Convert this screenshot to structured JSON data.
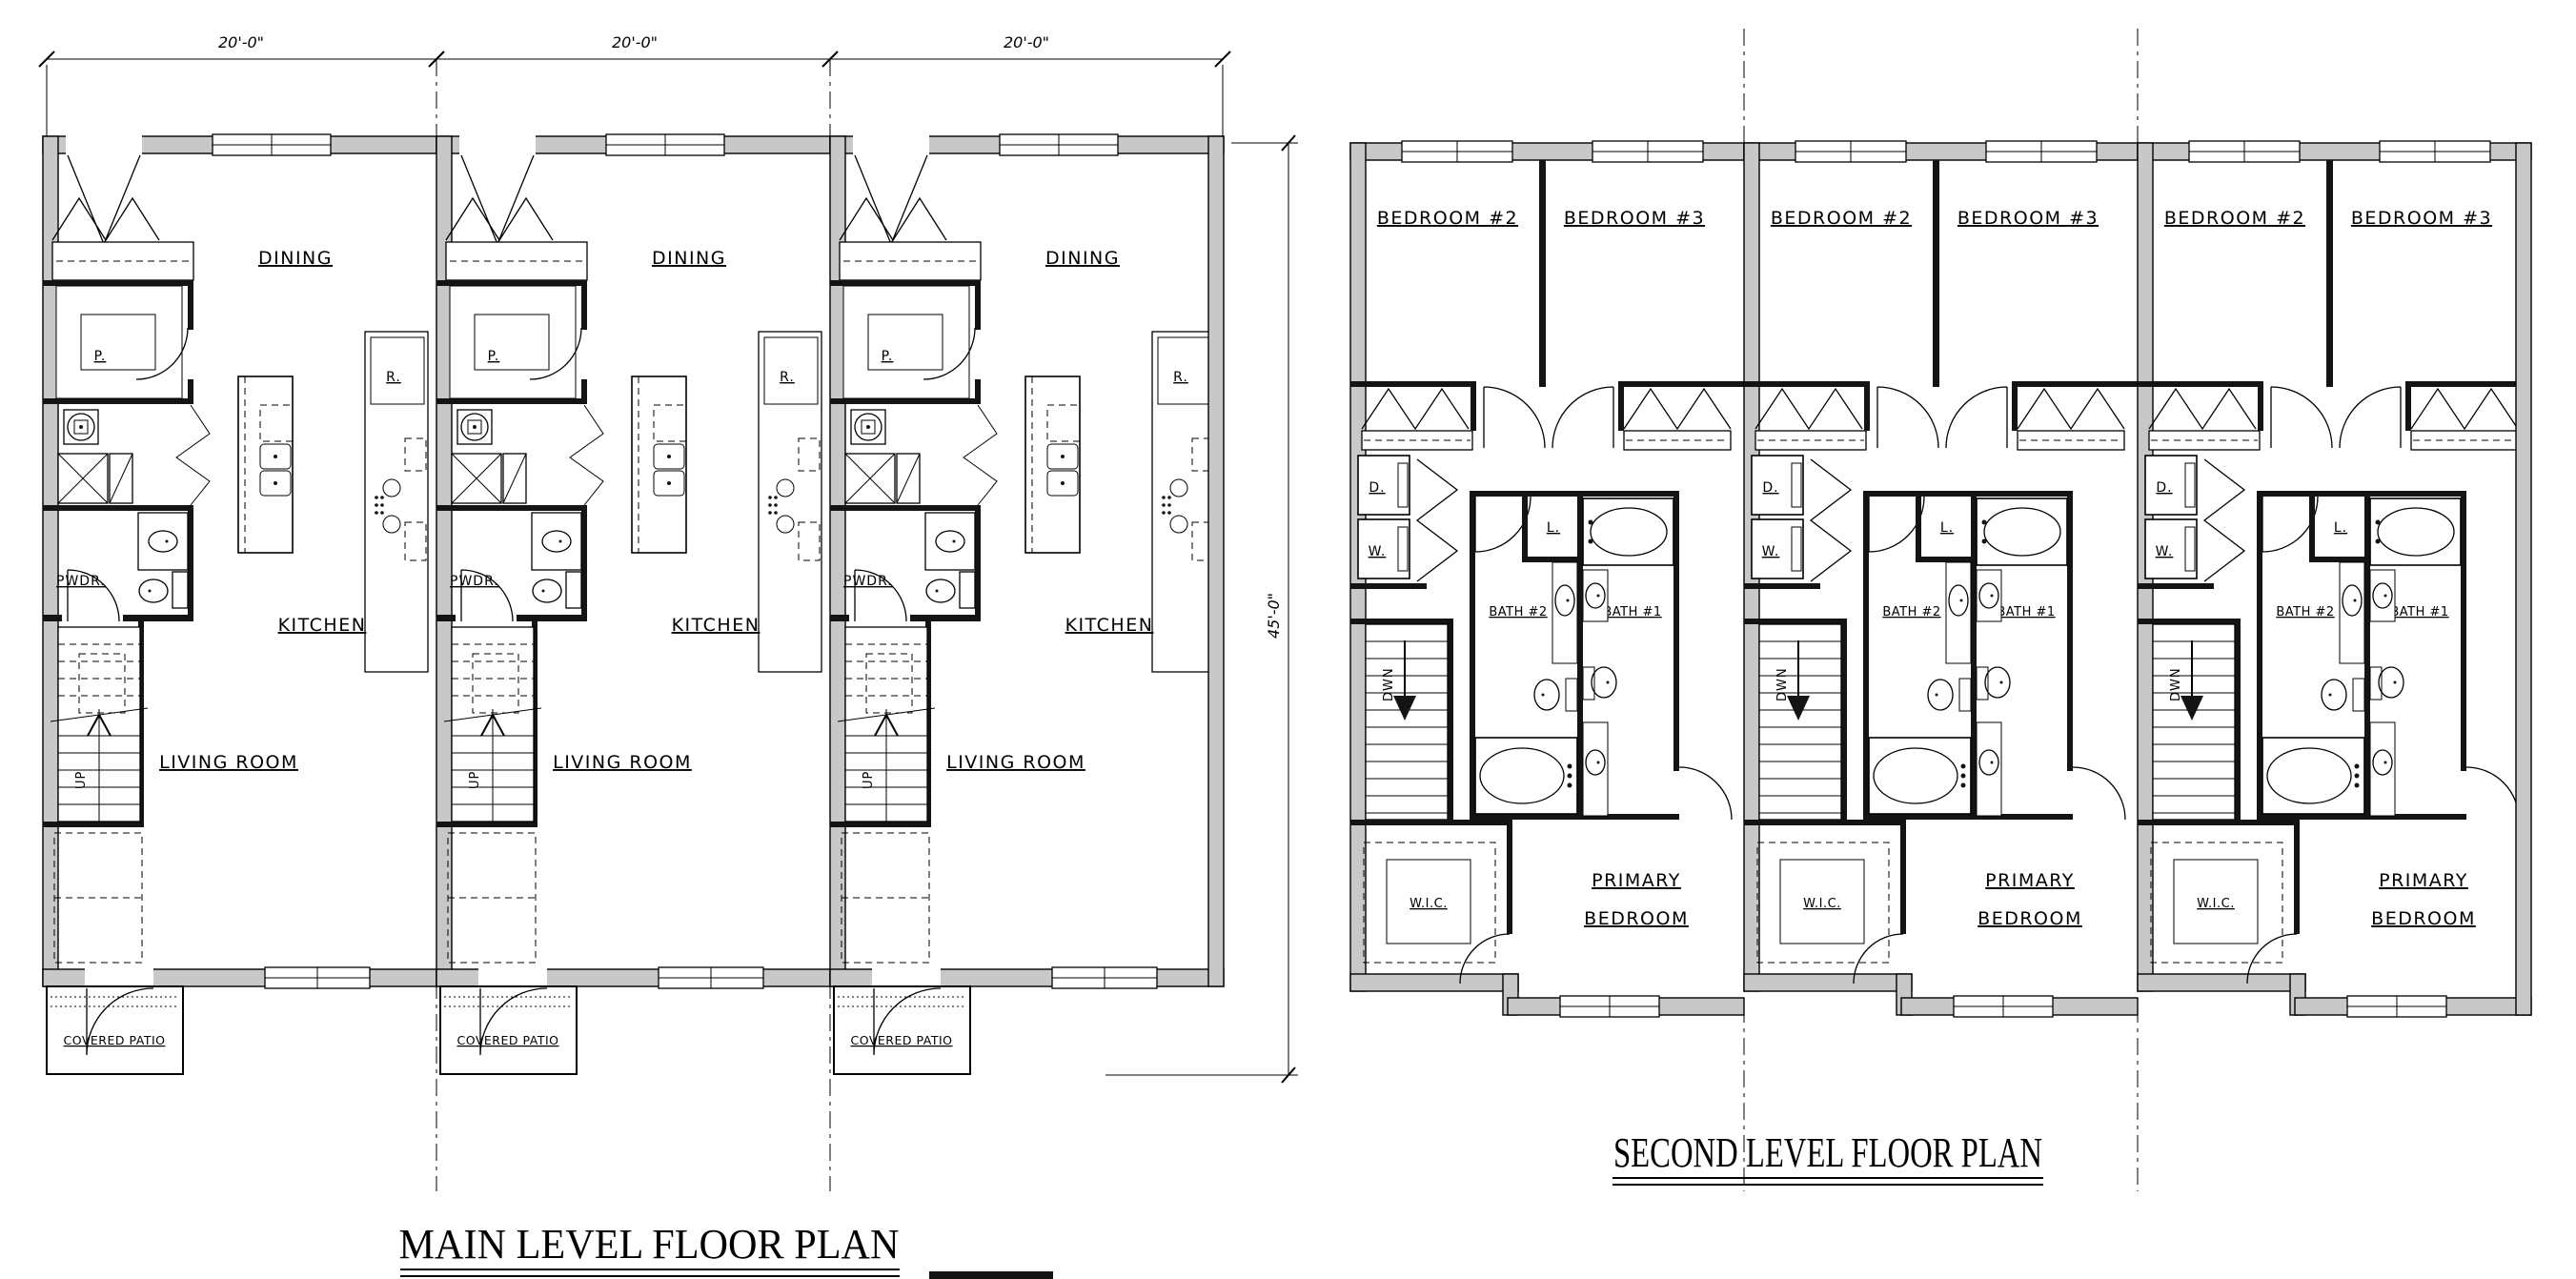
{
  "sheet": {
    "background": "#ffffff",
    "line_color": "#000000",
    "wall_fill": "#c8c8c8"
  },
  "main_plan": {
    "title": "MAIN LEVEL FLOOR PLAN",
    "unit_count": 3,
    "dim_top": [
      "20'-0\"",
      "20'-0\"",
      "20'-0\""
    ],
    "dim_right": "45'-0\"",
    "labels": {
      "dining": "DINING",
      "kitchen": "KITCHEN",
      "living_room": "LIVING ROOM",
      "powder": "PWDR.",
      "pantry": "P.",
      "refrigerator": "R.",
      "covered_patio": "COVERED PATIO",
      "stairs_up": "UP"
    }
  },
  "second_plan": {
    "title": "SECOND LEVEL FLOOR PLAN",
    "unit_count": 3,
    "labels": {
      "bedroom2": "BEDROOM #2",
      "bedroom3": "BEDROOM #3",
      "bath1": "BATH #1",
      "bath2": "BATH #2",
      "primary_bedroom": [
        "PRIMARY",
        "BEDROOM"
      ],
      "wic": "W.I.C.",
      "dryer": "D.",
      "washer": "W.",
      "linen": "L.",
      "stairs_down": "DWN"
    }
  }
}
